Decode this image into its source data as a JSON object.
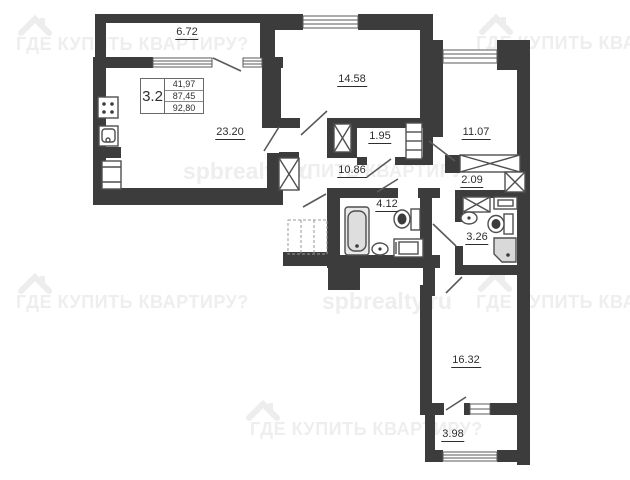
{
  "info_box": {
    "unit": "3.2",
    "rows": [
      "41,97",
      "87,45",
      "92,80"
    ]
  },
  "rooms": [
    {
      "id": "balcony-top",
      "area": "6.72"
    },
    {
      "id": "room-top",
      "area": "14.58"
    },
    {
      "id": "kitchen-living",
      "area": "23.20"
    },
    {
      "id": "closet",
      "area": "1.95"
    },
    {
      "id": "room-right",
      "area": "11.07"
    },
    {
      "id": "corridor",
      "area": "10.86"
    },
    {
      "id": "dressing",
      "area": "2.09"
    },
    {
      "id": "bathroom",
      "area": "4.12"
    },
    {
      "id": "shower-room",
      "area": "3.26"
    },
    {
      "id": "room-bottom",
      "area": "16.32"
    },
    {
      "id": "balcony-bottom",
      "area": "3.98"
    }
  ],
  "watermarks": {
    "brand": "ГДЕ КУПИТЬ КВАРТИРУ?",
    "brand_row2": "КУПИТЬ КВАРТИРУ?",
    "site": "spbrealty.ru",
    "color": "#eeeeee"
  },
  "colors": {
    "wall": "#3c3c3c",
    "fixture_stroke": "#4f4f4f",
    "shower_fill": "#d9d9d9"
  }
}
